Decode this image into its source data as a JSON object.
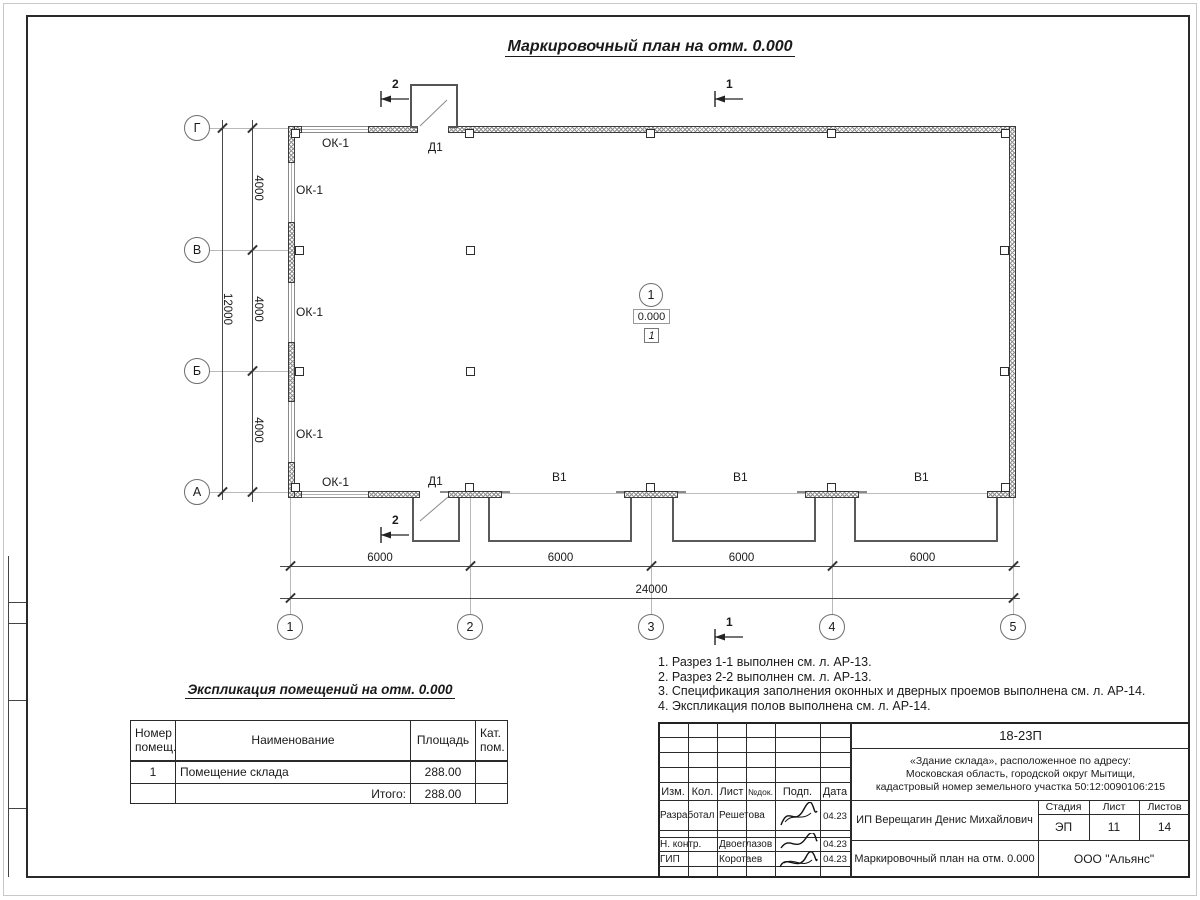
{
  "title": "Маркировочный план на отм. 0.000",
  "plan": {
    "axis_cols": [
      "1",
      "2",
      "3",
      "4",
      "5"
    ],
    "axis_rows": [
      "Г",
      "В",
      "Б",
      "А"
    ],
    "dims": {
      "bottom_segments": [
        "6000",
        "6000",
        "6000",
        "6000"
      ],
      "bottom_total": "24000",
      "left_segments": [
        "4000",
        "4000",
        "4000"
      ],
      "left_total": "12000"
    },
    "window_labels": [
      "ОК-1",
      "ОК-1",
      "ОК-1",
      "ОК-1",
      "ОК-1"
    ],
    "door_labels": [
      "Д1",
      "Д1"
    ],
    "gate_labels": [
      "В1",
      "В1",
      "В1"
    ],
    "section_marks": [
      "2",
      "1",
      "2",
      "1"
    ],
    "room_tag": {
      "number": "1",
      "elevation": "0.000",
      "floor_type": "1"
    }
  },
  "explication": {
    "title": "Экспликация помещений на отм. 0.000",
    "headers": [
      "Номер\nпомещ.",
      "Наименование",
      "Площадь",
      "Кат.\nпом."
    ],
    "row": {
      "num": "1",
      "name": "Помещение склада",
      "area": "288.00",
      "cat": ""
    },
    "total_label": "Итого:",
    "total_area": "288.00"
  },
  "notes": [
    "1. Разрез 1-1 выполнен см. л. АР-13.",
    "2. Разрез 2-2 выполнен см. л. АР-13.",
    "3. Спецификация заполнения оконных и дверных проемов выполнена см. л. АР-14.",
    "4. Экспликация полов выполнена см. л. АР-14."
  ],
  "stamp": {
    "code": "18-23П",
    "project": "«Здание склада», расположенное по адресу:\nМосковская область, городской округ Мытищи,\nкадастровый номер земельного участка 50:12:0090106:215",
    "client": "ИП Верещагин Денис Михайлович",
    "doc_title": "Маркировочный план на отм. 0.000",
    "company": "ООО \"Альянс\"",
    "header_cols": [
      "Изм.",
      "Кол.",
      "Лист",
      "№док.",
      "Подп.",
      "Дата"
    ],
    "stage_label": "Стадия",
    "sheet_label": "Лист",
    "sheets_label": "Листов",
    "stage": "ЭП",
    "sheet": "11",
    "sheets": "14",
    "roles": [
      {
        "role": "Разработал",
        "name": "Решетова",
        "date": "04.23"
      },
      {
        "role": "Н. контр.",
        "name": "Двоеглазов",
        "date": "04.23"
      },
      {
        "role": "ГИП",
        "name": "Коротаев",
        "date": "04.23"
      }
    ]
  }
}
